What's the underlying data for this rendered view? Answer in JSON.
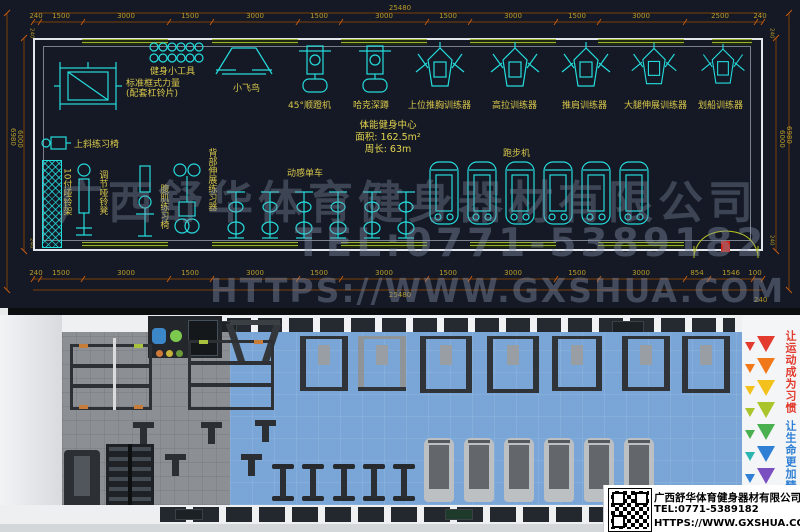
{
  "cad": {
    "top_total": "25480",
    "bottom_total": "25480",
    "bottom_corner": "240",
    "wall_thk": "240",
    "top_dims": [
      "240",
      "1500",
      "3000",
      "1500",
      "3000",
      "1500",
      "3000",
      "1500",
      "3000",
      "1500",
      "3000",
      "2500",
      "240"
    ],
    "bottom_dims": [
      "240",
      "1500",
      "3000",
      "1500",
      "3000",
      "1500",
      "3000",
      "1500",
      "3000",
      "1500",
      "3000",
      "854",
      "1546",
      "100"
    ],
    "left_outer": "6980",
    "left_inner": "6000",
    "right_outer": "6980",
    "right_inner": "6000",
    "room": {
      "title": "体能健身中心",
      "area": "面积: 162.5m²",
      "perimeter": "周长: 63m"
    },
    "equipment": {
      "tools": "健身小工具",
      "rack1": "标准框式力量",
      "rack2": "(配套杠铃片)",
      "fly": "小飞鸟",
      "legpress": "45°顺蹬机",
      "hack": "哈克深蹲",
      "chest": "上位推胸训练器",
      "lat": "高拉训练器",
      "shoulder": "推肩训练器",
      "legext": "大腿伸展训练器",
      "row": "划船训练器",
      "incline": "上斜练习椅",
      "dbrack": "10付哑铃架",
      "dbbench": "调节哑铃凳",
      "abbench": "腹肌练习椅",
      "backext": "背部伸展练习器",
      "spin": "动感单车",
      "tread": "跑步机"
    },
    "watermark": {
      "company": "广西舒华体育健身器材有限公司",
      "tel": "TEL:0771-5389182",
      "url": "HTTPS://WWW.GXSHUA.COM"
    },
    "colors": {
      "line_cyan": "#25dcdc",
      "dim_brown": "#7d3e08",
      "label_yellow": "#d9c74b",
      "window_green": "#9cb32c",
      "background": "#141925"
    }
  },
  "render": {
    "slogan_top": "让运动成为习惯",
    "slogan_bottom": "让生命更加精彩",
    "triangle_colors": [
      "#e23b2e",
      "#f07818",
      "#f3c11b",
      "#a8c62c",
      "#4aaf4e",
      "#2ab5b0",
      "#2f7fd4",
      "#7a4fc0"
    ],
    "floor_colors": {
      "gray": "#8c8f93",
      "blue": "#79a6d6"
    },
    "info": {
      "company": "广西舒华体育健身器材有限公司",
      "tel": "TEL:0771-5389182",
      "url": "HTTPS://WWW.GXSHUA.COM"
    }
  }
}
